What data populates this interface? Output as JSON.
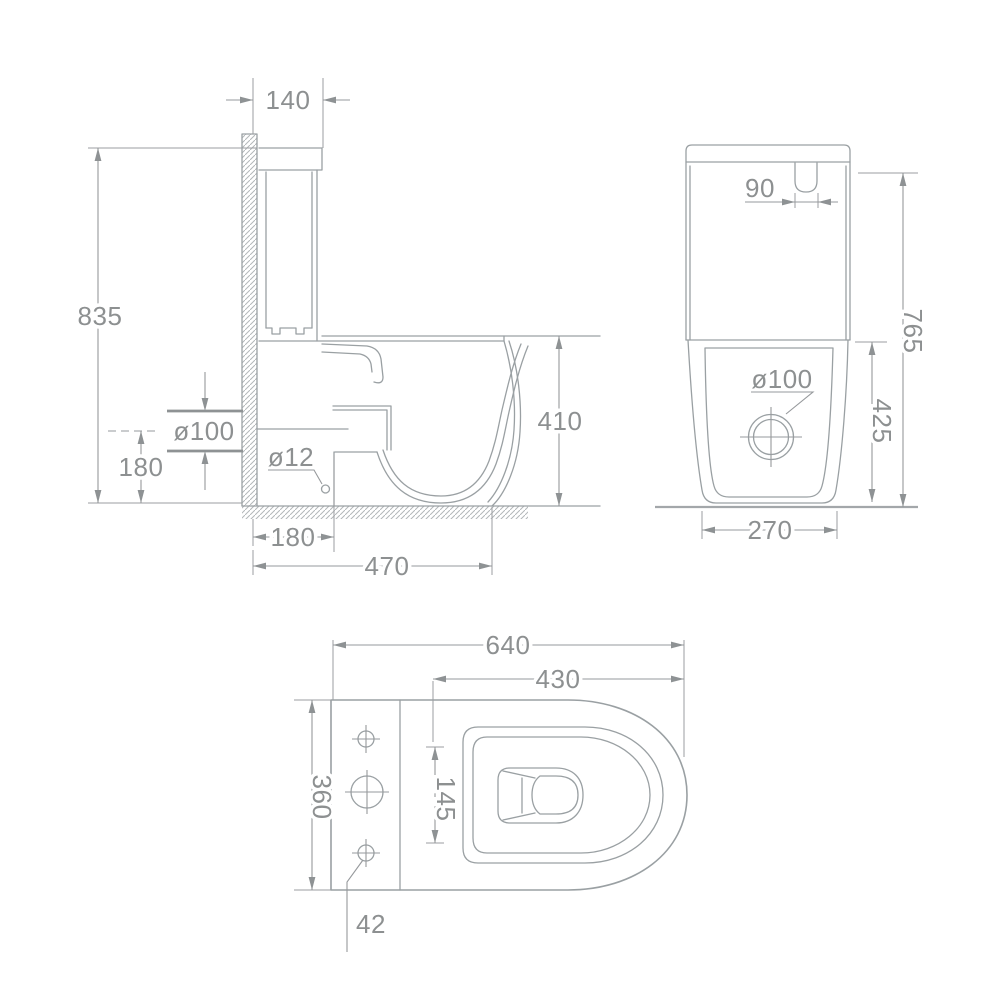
{
  "drawing": {
    "colors": {
      "background": "#ffffff",
      "lines": "#9aa0a3",
      "text": "#8d9091"
    },
    "side_view": {
      "name": "Side section view",
      "tank_top_depth": "140",
      "overall_height": "835",
      "outlet_pipe_diameter": "ø100",
      "outlet_center_height": "180",
      "fixing_hole_diameter": "ø12",
      "outlet_offset_from_wall": "180",
      "depth_to_front": "470",
      "rim_height": "410"
    },
    "front_view": {
      "name": "Front view",
      "button_offset": "90",
      "overall_height": "765",
      "drain_diameter": "ø100",
      "bowl_section_height": "425",
      "base_width": "270"
    },
    "plan_view": {
      "name": "Top view",
      "overall_length": "640",
      "seat_length": "430",
      "overall_width": "360",
      "hinge_hole_spacing": "145",
      "hole_edge_offset": "42"
    }
  }
}
